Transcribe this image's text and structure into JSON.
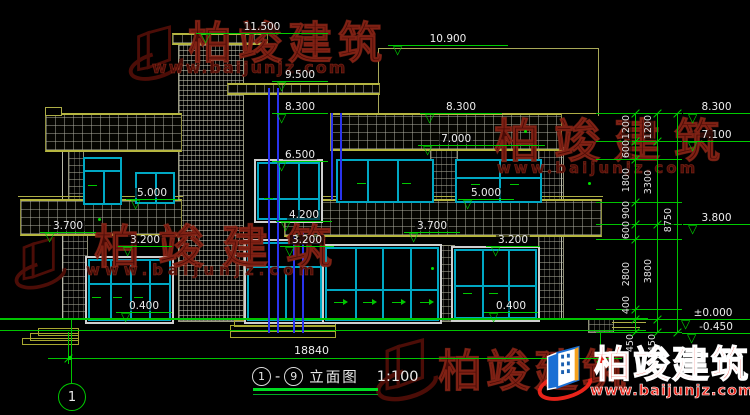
{
  "drawing_title": {
    "axis_from": "1",
    "separator": "-",
    "axis_to": "9",
    "name": "立面图",
    "scale": "1:100"
  },
  "grid_axis_label": "1",
  "elev": {
    "m11500": "11.500",
    "m10900": "10.900",
    "m9500": "9.500",
    "m8300l": "8.300",
    "m8300r": "8.300",
    "m7000": "7.000",
    "m6500": "6.500",
    "m5000l": "5.000",
    "m5000r": "5.000",
    "m4200": "4.200",
    "m3700l": "3.700",
    "m3700r": "3.700",
    "m3200l": "3.200",
    "m3200c": "3.200",
    "m3200r": "3.200",
    "m0400l": "0.400",
    "m0400r": "0.400",
    "mg8300": "8.300",
    "mg7100": "7.100",
    "mg3800": "3.800",
    "mg0000": "±0.000",
    "mg0450": "-0.450"
  },
  "dims": {
    "inner": [
      "1200",
      "600",
      "1800",
      "900",
      "600",
      "2800",
      "400",
      "450"
    ],
    "middle": [
      "1200",
      "3300",
      "3800",
      "450"
    ],
    "total": "8750",
    "width": "18840"
  },
  "watermark": {
    "brand": "柏竣建筑",
    "site": "www.baijunjz.com"
  },
  "colors": {
    "annotation_green": "#00cc00",
    "slab_olive": "#b6b640",
    "window_cyan": "#00a8c4",
    "pipe_blue": "#2a34ee",
    "watermark_red": "#e8241a"
  }
}
